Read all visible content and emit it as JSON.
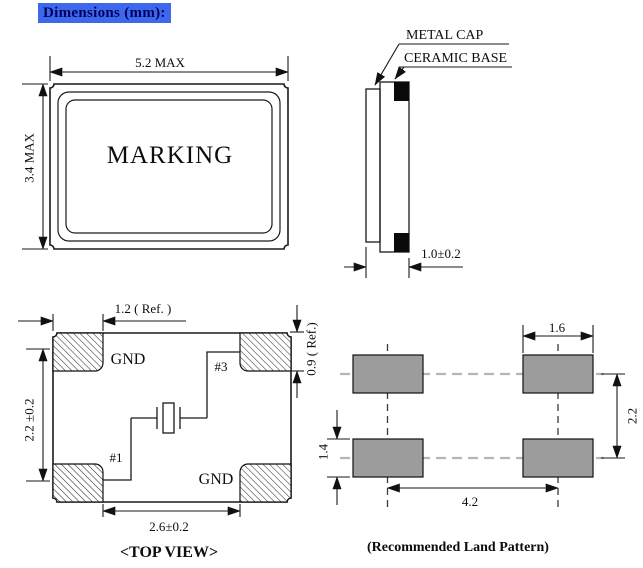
{
  "header": {
    "label": "Dimensions (mm):"
  },
  "front_view": {
    "marking_label": "MARKING",
    "width_dim": "5.2 MAX",
    "height_dim": "3.4 MAX"
  },
  "side_view": {
    "metal_cap_label": "METAL CAP",
    "ceramic_base_label": "CERAMIC BASE",
    "thickness_dim": "1.0±0.2"
  },
  "top_view": {
    "title": "<TOP VIEW>",
    "pads": {
      "top_left": "GND",
      "top_right": "#3",
      "bottom_left": "#1",
      "bottom_right": "GND"
    },
    "dims": {
      "corner_pad_width": "1.2 ( Ref. )",
      "vertical_pad_spacing": "2.2 ±0.2",
      "corner_pad_height": "0.9 ( Ref.)",
      "inner_pad_gap": "2.6±0.2"
    }
  },
  "land_pattern": {
    "title": "(Recommended Land Pattern)",
    "dims": {
      "pad_width": "1.6",
      "row_spacing": "2.2",
      "pad_height": "1.4",
      "column_spacing": "4.2"
    },
    "colors": {
      "pad_fill": "#9c9c9c"
    }
  },
  "colors": {
    "header_highlight": "#3d68ec",
    "header_text": "#000060",
    "line_color": "#1a1a1a"
  }
}
